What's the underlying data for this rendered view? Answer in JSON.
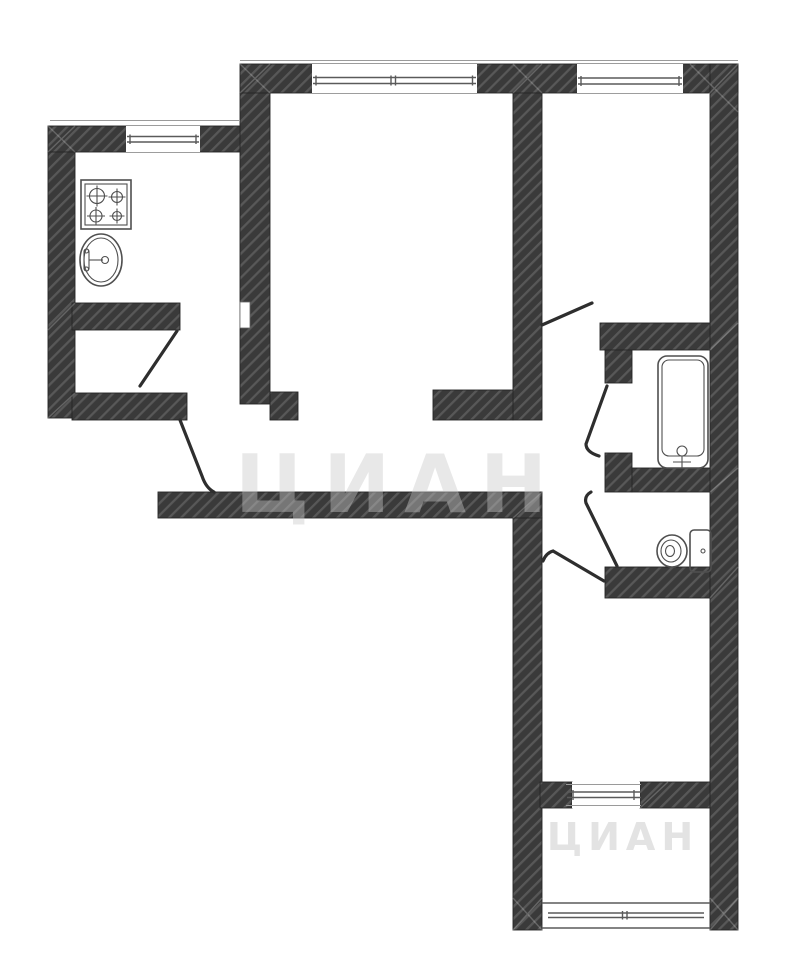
{
  "page": {
    "background": "#ffffff",
    "type": "apartment-floor-plan"
  },
  "colors": {
    "background": "#ffffff",
    "wall": "#3a3a3a",
    "hatch": "#585858",
    "wall-edge": "#262626",
    "line": "#4f4f4f",
    "door": "#2e2e2e",
    "frame": "#5a5a5a",
    "contour": "#9a9a9a",
    "watermark": "#c9c9c9"
  },
  "watermark": {
    "text": "ЦИАН"
  },
  "plan": {
    "fixtures": [
      "stove-icon",
      "sink-icon",
      "bathtub-icon",
      "toilet-icon"
    ],
    "windows": [
      "kitchen-window",
      "room1-window",
      "room2-window",
      "corridor-inner-window",
      "balcony-window"
    ],
    "doors": [
      "kitchen-door",
      "entrance-door",
      "room2-door",
      "bathroom-door",
      "toilet-door",
      "corridor-door"
    ]
  }
}
